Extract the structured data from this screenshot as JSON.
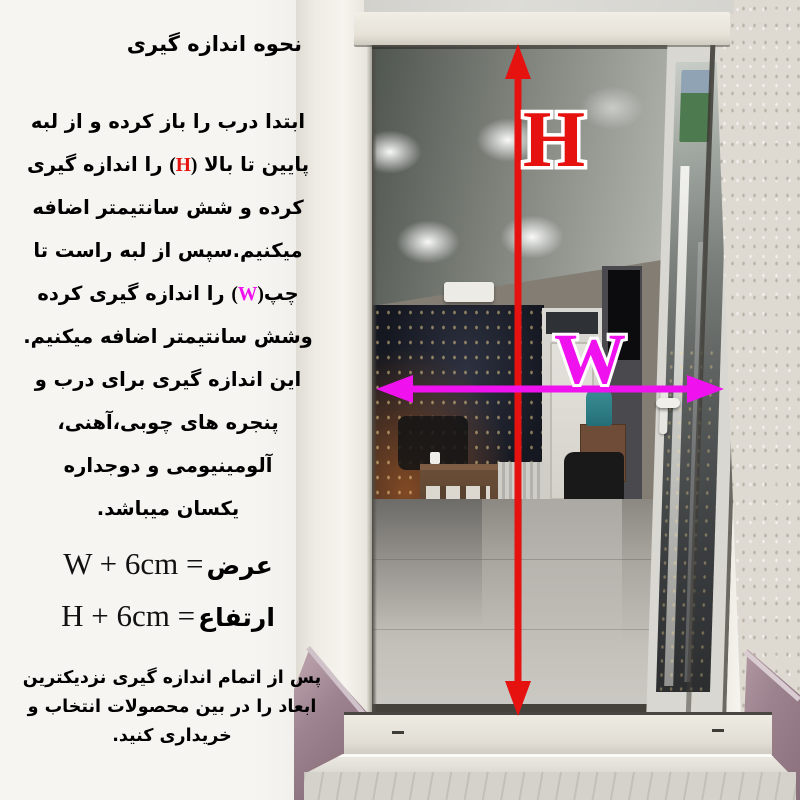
{
  "instructions": {
    "title": "نحوه اندازه گیری",
    "para": {
      "l1": "ابتدا درب را باز کرده و از لبه",
      "l2a": "پایین تا بالا ",
      "l2_open": "(",
      "l2_letter": "H",
      "l2_close": ")",
      "l2b": " را اندازه گیری",
      "l3": "کرده و شش سانتیمتر اضافه",
      "l4": "میکنیم.سپس از لبه راست تا",
      "l5a": "چپ",
      "l5_open": "(",
      "l5_letter": "W",
      "l5_close": ")",
      "l5b": " را اندازه گیری کرده",
      "l6": "وشش سانتیمتر اضافه میکنیم.",
      "l7": "این اندازه گیری برای درب و",
      "l8": "پنجره های چوبی،آهنی،",
      "l9": "آلومینیومی و دوجداره",
      "l10": "یکسان میباشد."
    },
    "formulas": {
      "width": {
        "latin": "W + 6cm =",
        "label": "عرض"
      },
      "height": {
        "latin": "H + 6cm =",
        "label": "ارتفاع"
      }
    },
    "note": {
      "line1": "پس از اتمام اندازه گیری نزدیکترین",
      "line2": "ابعاد را در بین محصولات انتخاب و",
      "line3": "خریداری کنید."
    }
  },
  "photo": {
    "height_letter": "H",
    "width_letter": "W",
    "height_color": "#e51210",
    "width_color": "#ef12ee",
    "letter_outline": "#ffffff"
  }
}
